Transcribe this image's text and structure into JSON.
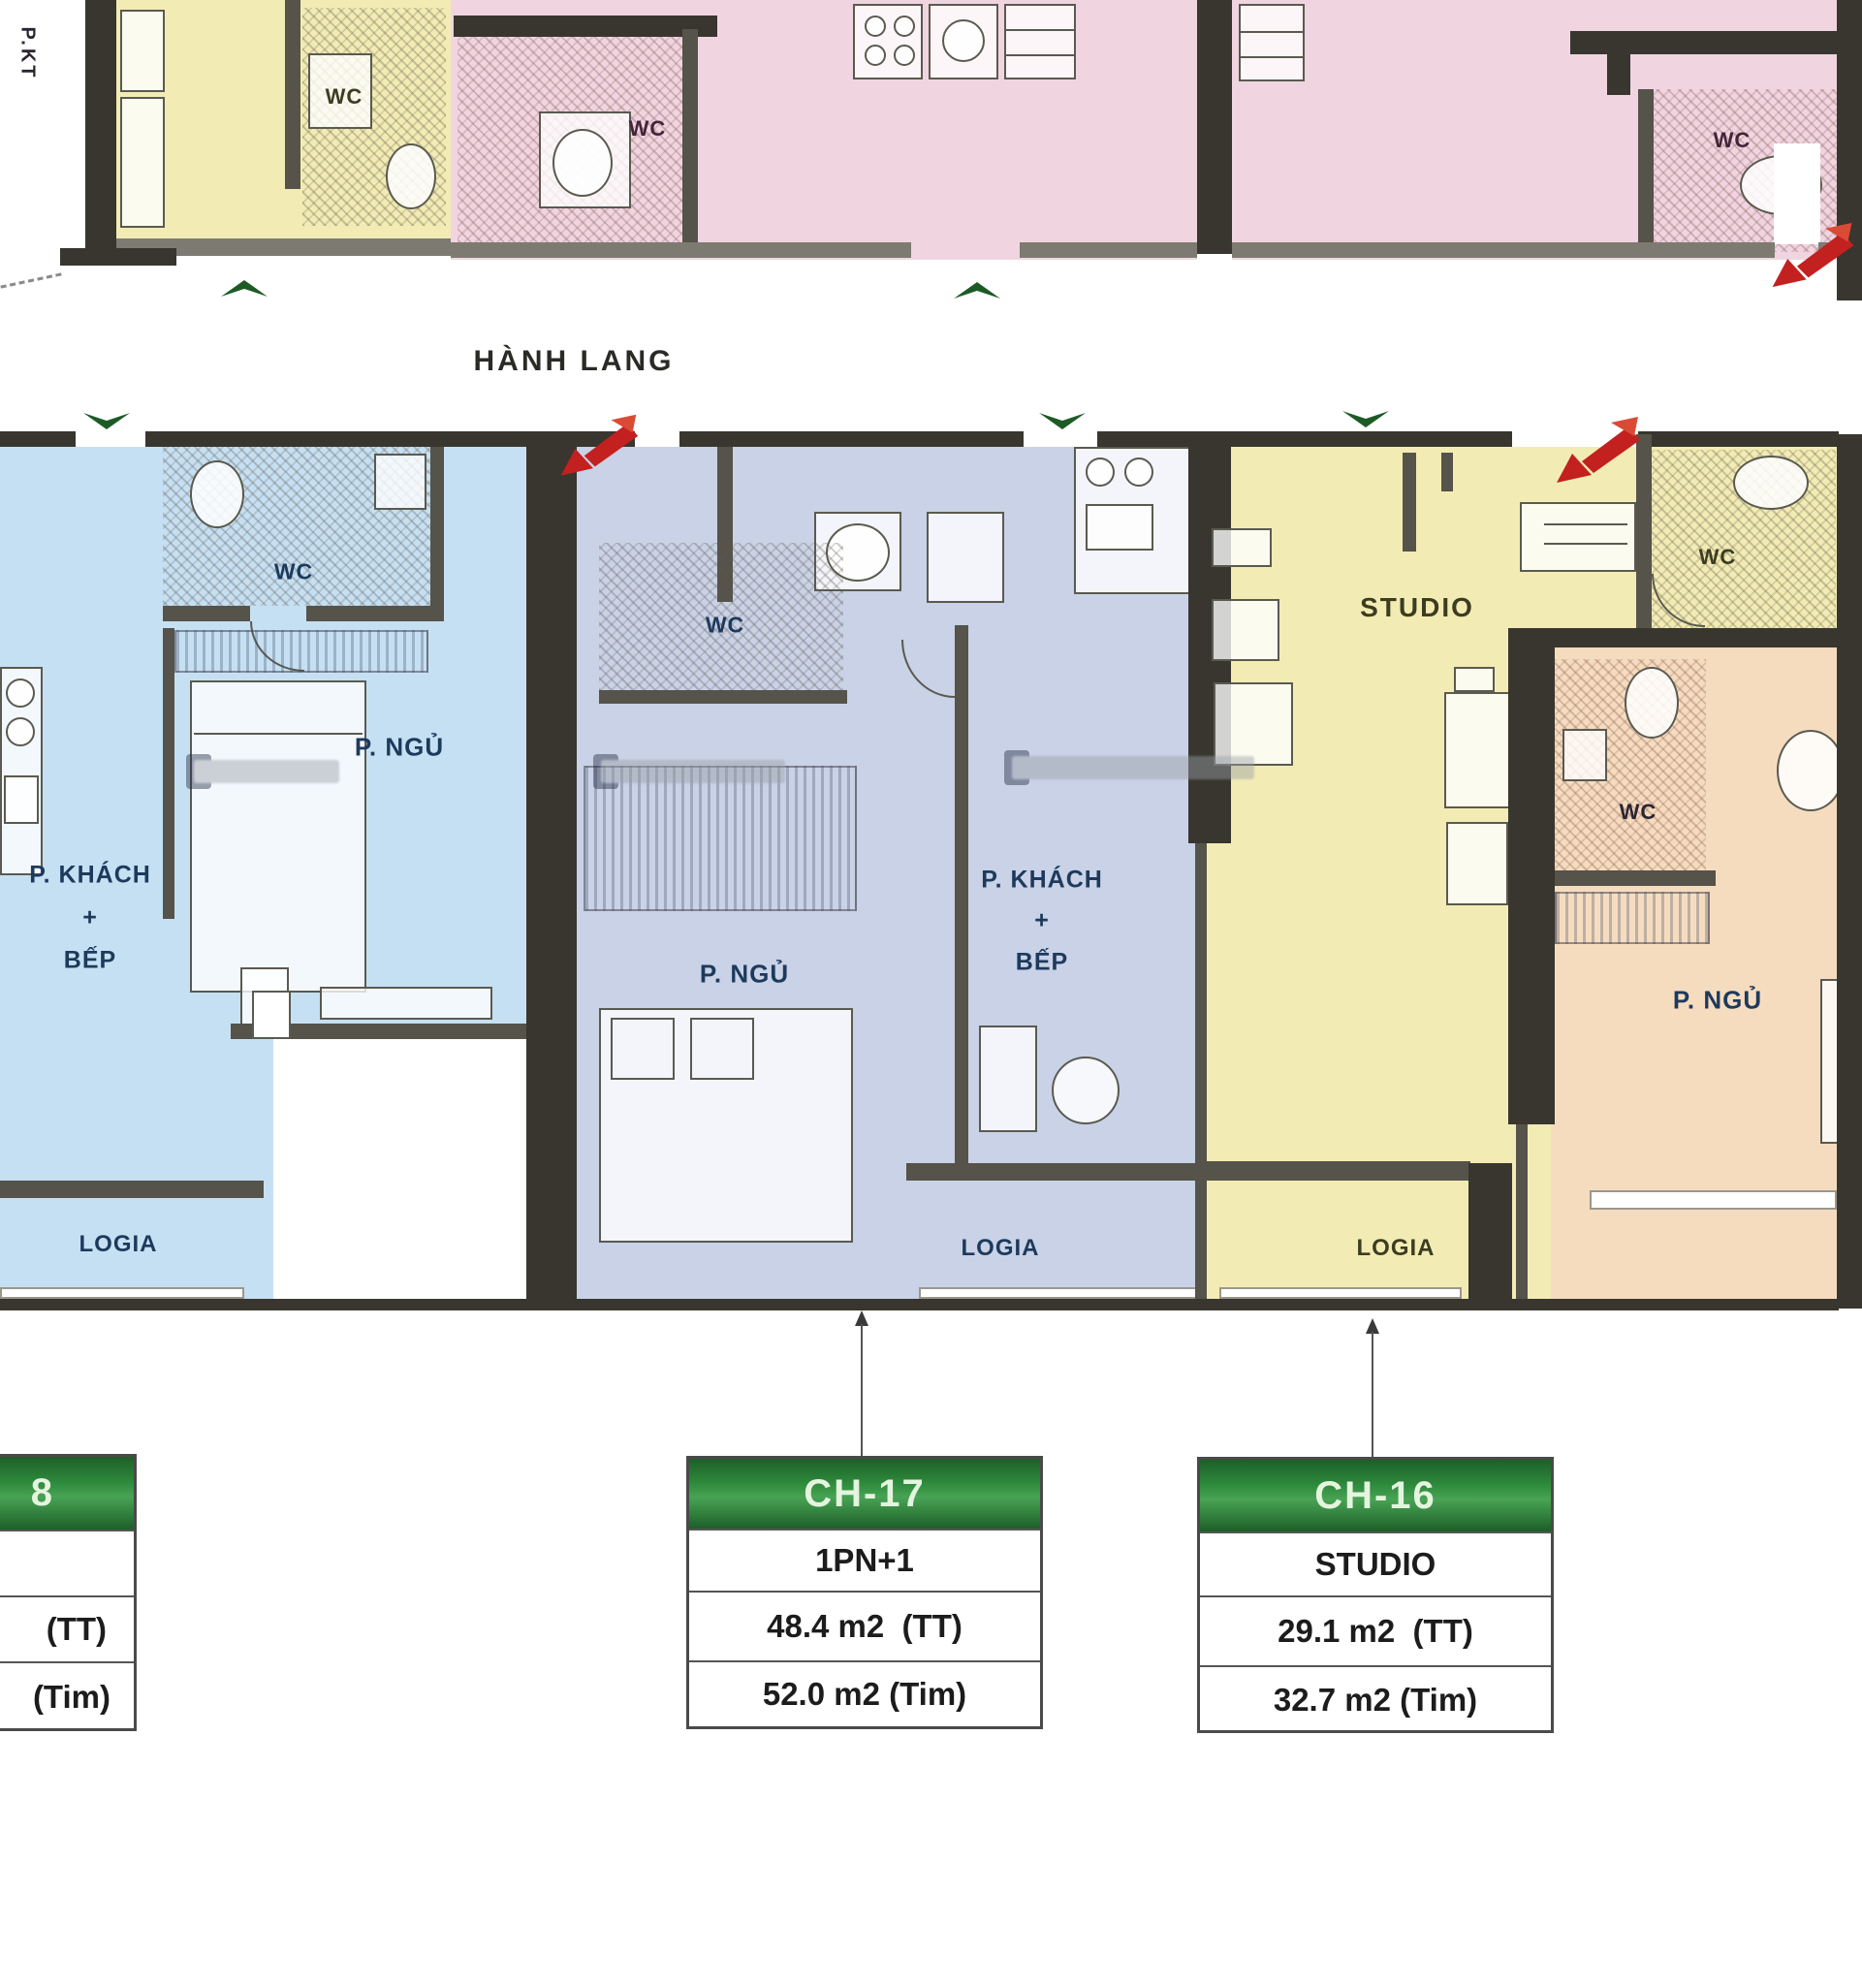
{
  "plan_type": "apartment-floor-plan",
  "colors": {
    "unit_yellow": "#f2ecb4",
    "unit_pink": "#f0d5e1",
    "unit_blue": "#c6e0f3",
    "unit_periwinkle": "#c9d2e6",
    "unit_orange": "#f6dcbf",
    "wall_dark": "#38362f",
    "wall_gray": "#7d7a72",
    "table_header_green": "#2e8a3c",
    "entry_arrow_green": "#1d5b26",
    "highlight_arrow_red": "#c32020",
    "label_navy": "#1d3a5c"
  },
  "labels": {
    "pkt": "P.KT",
    "hanh_lang": "HÀNH LANG",
    "wc": "WC",
    "p_ngu": "P. NGỦ",
    "p_khach": "P. KHÁCH",
    "plus": "+",
    "bep": "BẾP",
    "logia": "LOGIA",
    "studio": "STUDIO"
  },
  "tables": {
    "left_partial": {
      "header_fragment": "8",
      "type": "",
      "area_tt": "(TT)",
      "area_tim": "(Tim)"
    },
    "ch17": {
      "header": "CH-17",
      "type": "1PN+1",
      "area_tt": "48.4 m2  (TT)",
      "area_tim": "52.0 m2 (Tim)"
    },
    "ch16": {
      "header": "CH-16",
      "type": "STUDIO",
      "area_tt": "29.1 m2  (TT)",
      "area_tim": "32.7 m2 (Tim)"
    }
  }
}
